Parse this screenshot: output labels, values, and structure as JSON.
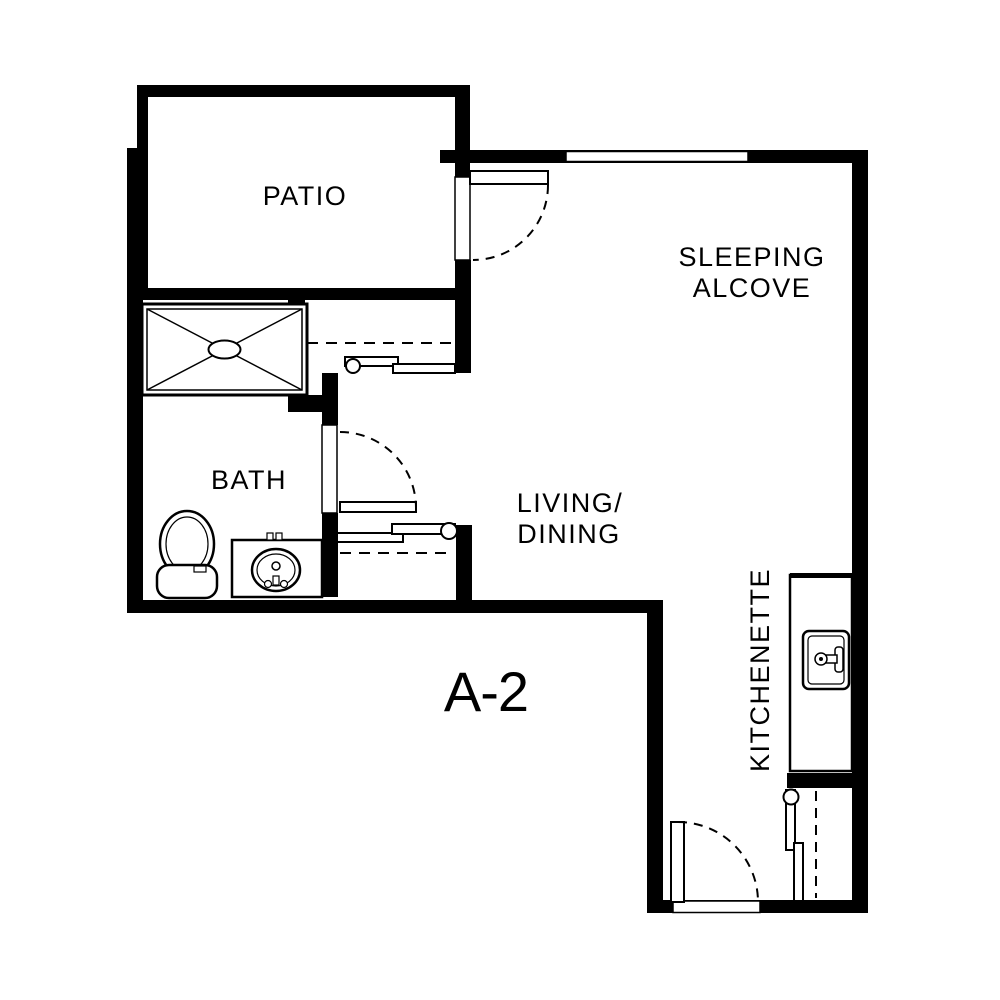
{
  "page": {
    "background_color": "#ffffff",
    "line_color": "#000000",
    "type": "apartment floor plan"
  },
  "floor_plan": {
    "unit_label": "A-2",
    "rooms": [
      {
        "id": "patio",
        "label": "PATIO"
      },
      {
        "id": "sleeping-alcove",
        "label": "SLEEPING",
        "label2": "ALCOVE"
      },
      {
        "id": "bath",
        "label": "BATH"
      },
      {
        "id": "living-dining",
        "label": "LIVING/",
        "label2": "DINING"
      },
      {
        "id": "kitchenette",
        "label": "KITCHENETTE"
      }
    ],
    "fixtures": [
      {
        "id": "shower-pan",
        "description": "rectangular shower with X drain symbol"
      },
      {
        "id": "toilet",
        "description": "toilet with oval bowl and tank"
      },
      {
        "id": "vanity-sink",
        "description": "bath vanity with oval basin and faucet"
      },
      {
        "id": "kitchen-sink",
        "description": "kitchenette counter sink with faucet"
      },
      {
        "id": "wardrobe-closet-upper",
        "description": "sliding-door closet below patio"
      },
      {
        "id": "wardrobe-closet-lower",
        "description": "sliding-door closet beside vanity"
      },
      {
        "id": "entry-closet",
        "description": "sliding-door closet at entry"
      },
      {
        "id": "patio-door",
        "description": "swing door between patio and sleeping alcove"
      },
      {
        "id": "bath-door",
        "description": "swing door into bath"
      },
      {
        "id": "entry-door",
        "description": "entry swing door in bottom wall"
      },
      {
        "id": "window-top",
        "description": "window in sleeping alcove top wall"
      }
    ]
  }
}
